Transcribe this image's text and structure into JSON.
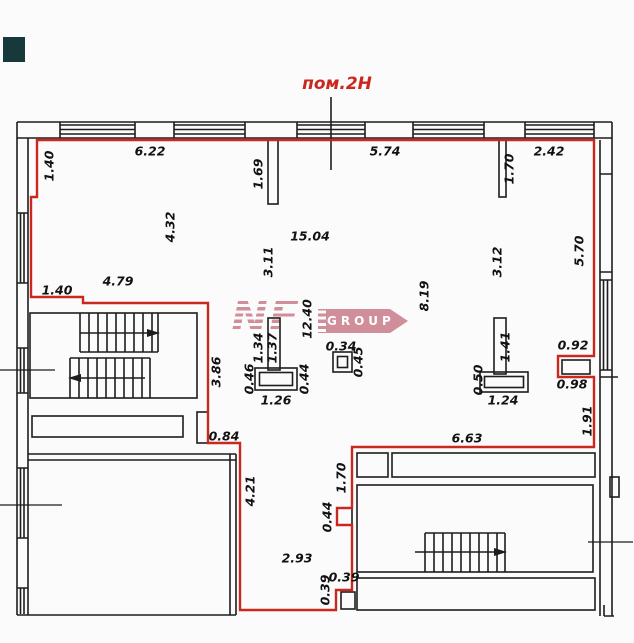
{
  "title": {
    "room_label": "пом.2Н"
  },
  "watermark": {
    "letters": "NF",
    "banner_text": "GROUP"
  },
  "colors": {
    "boundary_red": "#c9281e",
    "ink": "#1d1d1d",
    "watermark_pink": "#cf8e99",
    "logo_teal": "#17393b",
    "canvas": "#fbfbfb"
  },
  "plan": {
    "dimensions": [
      {
        "text": "6.22",
        "x": 150,
        "y": 151,
        "rot": 0
      },
      {
        "text": "5.74",
        "x": 385,
        "y": 151,
        "rot": 0
      },
      {
        "text": "2.42",
        "x": 549,
        "y": 151,
        "rot": 0
      },
      {
        "text": "1.40",
        "x": 49,
        "y": 166,
        "rot": 1
      },
      {
        "text": "1.69",
        "x": 258,
        "y": 174,
        "rot": 1
      },
      {
        "text": "1.70",
        "x": 509,
        "y": 169,
        "rot": 1
      },
      {
        "text": "4.32",
        "x": 170,
        "y": 227,
        "rot": 1
      },
      {
        "text": "15.04",
        "x": 310,
        "y": 236,
        "rot": 0
      },
      {
        "text": "3.11",
        "x": 268,
        "y": 262,
        "rot": 1
      },
      {
        "text": "3.12",
        "x": 497,
        "y": 262,
        "rot": 1
      },
      {
        "text": "5.70",
        "x": 579,
        "y": 251,
        "rot": 1
      },
      {
        "text": "8.19",
        "x": 424,
        "y": 296,
        "rot": 1
      },
      {
        "text": "4.79",
        "x": 118,
        "y": 281,
        "rot": 0
      },
      {
        "text": "1.40",
        "x": 57,
        "y": 290,
        "rot": 0
      },
      {
        "text": "12.40",
        "x": 307,
        "y": 319,
        "rot": 1
      },
      {
        "text": "1.34",
        "x": 258,
        "y": 348,
        "rot": 1
      },
      {
        "text": "1.37",
        "x": 272,
        "y": 348,
        "rot": 1
      },
      {
        "text": "0.34",
        "x": 341,
        "y": 346,
        "rot": 0
      },
      {
        "text": "0.45",
        "x": 358,
        "y": 362,
        "rot": 1
      },
      {
        "text": "3.86",
        "x": 216,
        "y": 372,
        "rot": 1
      },
      {
        "text": "0.46",
        "x": 249,
        "y": 379,
        "rot": 1
      },
      {
        "text": "0.44",
        "x": 304,
        "y": 379,
        "rot": 1
      },
      {
        "text": "1.26",
        "x": 276,
        "y": 400,
        "rot": 0
      },
      {
        "text": "1.41",
        "x": 505,
        "y": 347,
        "rot": 1
      },
      {
        "text": "0.50",
        "x": 478,
        "y": 380,
        "rot": 1
      },
      {
        "text": "1.24",
        "x": 503,
        "y": 400,
        "rot": 0
      },
      {
        "text": "0.92",
        "x": 573,
        "y": 345,
        "rot": 0
      },
      {
        "text": "0.98",
        "x": 572,
        "y": 384,
        "rot": 0
      },
      {
        "text": "1.91",
        "x": 587,
        "y": 421,
        "rot": 1
      },
      {
        "text": "0.84",
        "x": 224,
        "y": 436,
        "rot": 0
      },
      {
        "text": "6.63",
        "x": 467,
        "y": 438,
        "rot": 0
      },
      {
        "text": "4.21",
        "x": 250,
        "y": 491,
        "rot": 1
      },
      {
        "text": "1.70",
        "x": 341,
        "y": 478,
        "rot": 1
      },
      {
        "text": "0.44",
        "x": 327,
        "y": 517,
        "rot": 1
      },
      {
        "text": "2.93",
        "x": 297,
        "y": 558,
        "rot": 0
      },
      {
        "text": "0.39",
        "x": 344,
        "y": 577,
        "rot": 0
      },
      {
        "text": "0.39",
        "x": 325,
        "y": 590,
        "rot": 1
      }
    ]
  }
}
